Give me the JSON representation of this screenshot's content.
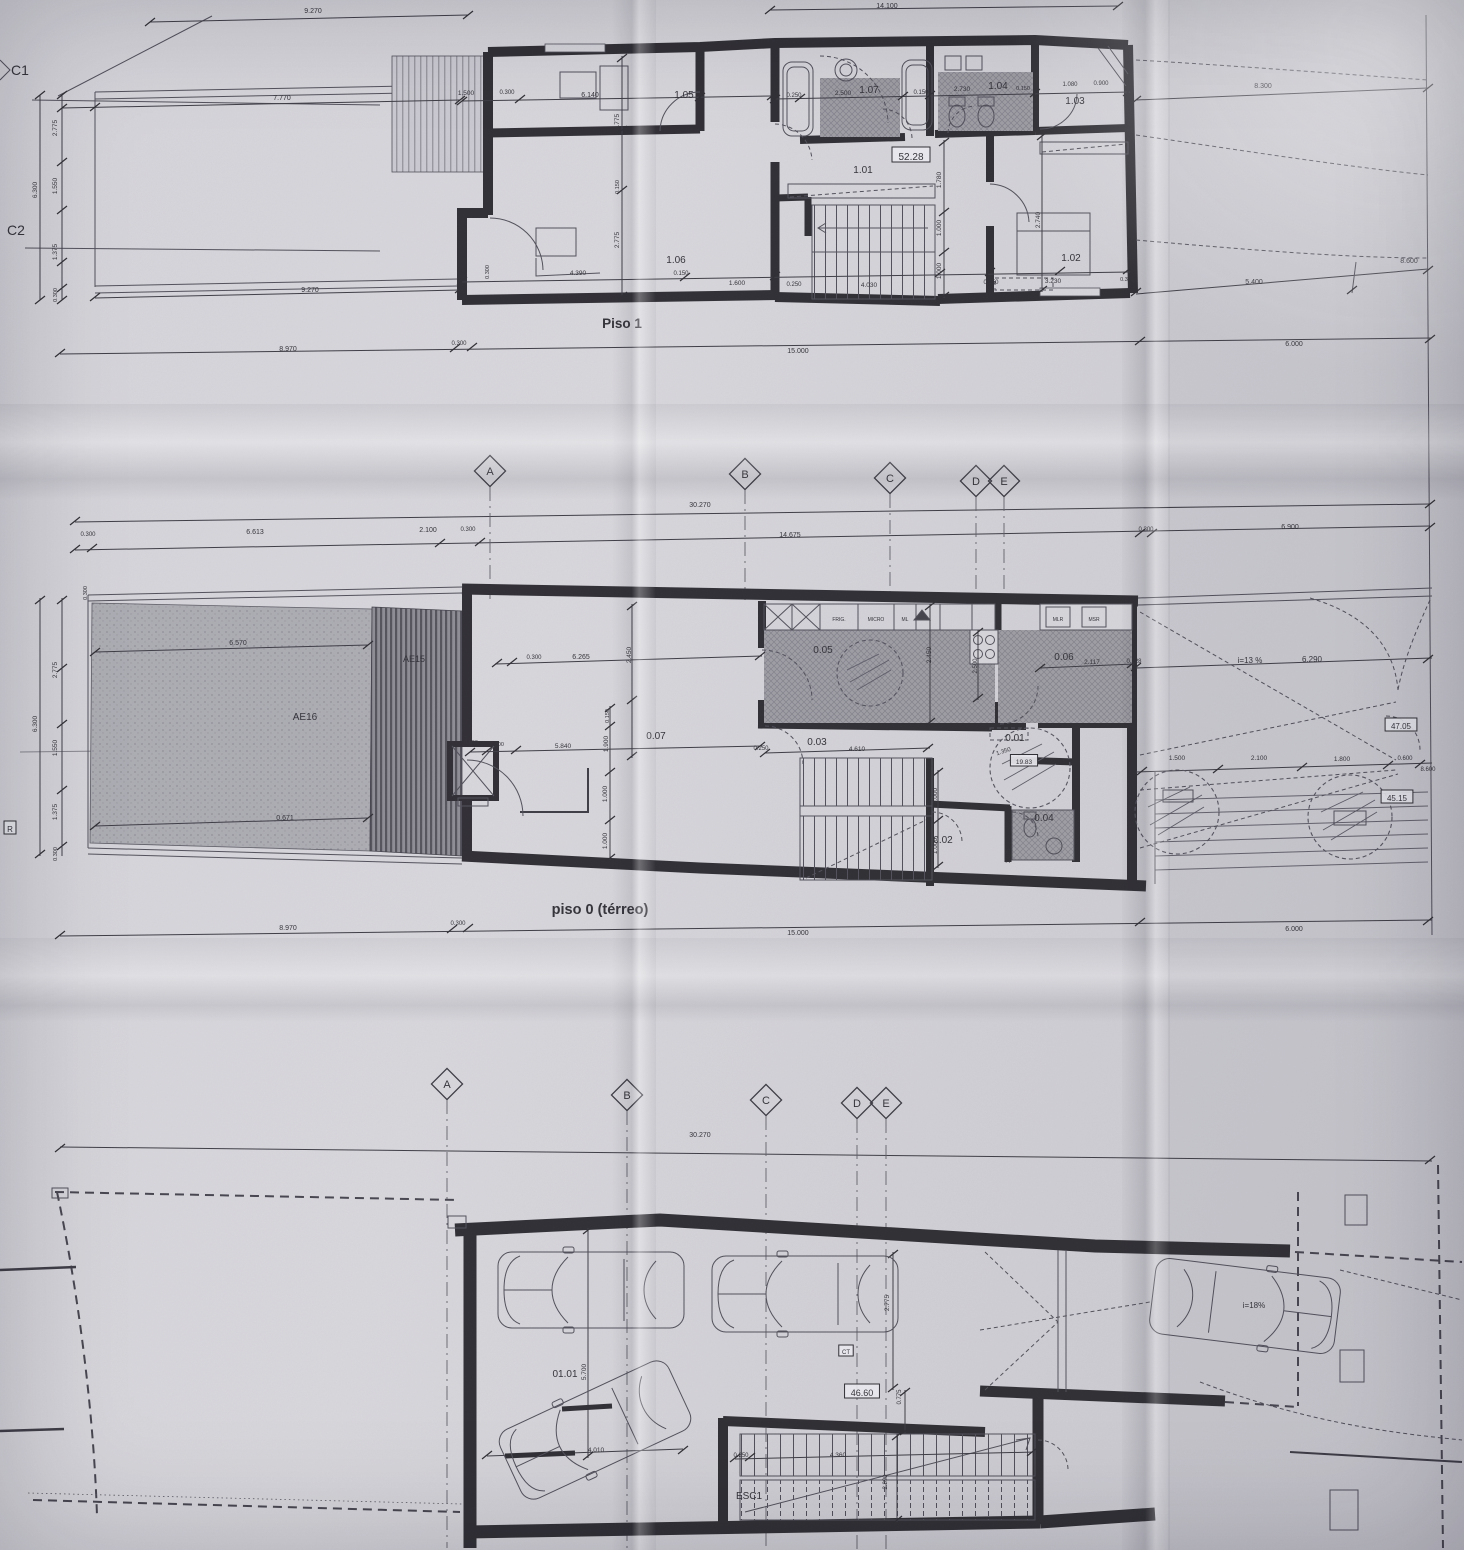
{
  "titles": {
    "piso1": "Piso 1",
    "piso0": "piso 0 (térreo)"
  },
  "labels": {
    "piso1": [
      {
        "t": "9.270",
        "x": 313,
        "y": 13,
        "s": 7
      },
      {
        "t": "14.100",
        "x": 887,
        "y": 8,
        "s": 7
      },
      {
        "t": "C1",
        "x": 20,
        "y": 75,
        "s": 14,
        "n": "grid-label-c1"
      },
      {
        "t": "C2",
        "x": 16,
        "y": 235,
        "s": 14,
        "n": "grid-label-c2"
      },
      {
        "t": "7.770",
        "x": 282,
        "y": 100,
        "s": 7
      },
      {
        "t": "2.775",
        "x": 57,
        "y": 128,
        "r": -90,
        "s": 6.5
      },
      {
        "t": "6.300",
        "x": 37,
        "y": 190,
        "r": -90,
        "s": 6.5
      },
      {
        "t": "1.550",
        "x": 57,
        "y": 186,
        "r": -90,
        "s": 6.5
      },
      {
        "t": "1.375",
        "x": 57,
        "y": 252,
        "r": -90,
        "s": 6.5
      },
      {
        "t": "0.300",
        "x": 57,
        "y": 295,
        "r": -90,
        "s": 5.5
      },
      {
        "t": "1.500",
        "x": 466,
        "y": 95,
        "s": 6.5
      },
      {
        "t": "0.300",
        "x": 507,
        "y": 94,
        "s": 6
      },
      {
        "t": "6.140",
        "x": 590,
        "y": 97,
        "s": 7
      },
      {
        "t": "1.05",
        "x": 684,
        "y": 98,
        "s": 10,
        "n": "room-label-1-05"
      },
      {
        "t": "2.775",
        "x": 619,
        "y": 122,
        "r": -90,
        "s": 6.5
      },
      {
        "t": "0.250",
        "x": 794,
        "y": 97,
        "s": 6
      },
      {
        "t": "2.500",
        "x": 843,
        "y": 95,
        "s": 6.5
      },
      {
        "t": "1.07",
        "x": 869,
        "y": 93,
        "s": 10,
        "n": "room-label-1-07"
      },
      {
        "t": "0.150",
        "x": 921,
        "y": 94,
        "s": 6
      },
      {
        "t": "2.730",
        "x": 962,
        "y": 91,
        "s": 6.5
      },
      {
        "t": "1.04",
        "x": 998,
        "y": 89,
        "s": 10,
        "n": "room-label-1-04"
      },
      {
        "t": "0.150",
        "x": 1023,
        "y": 90,
        "s": 5.5
      },
      {
        "t": "1.080",
        "x": 1070,
        "y": 86,
        "s": 6
      },
      {
        "t": "0.900",
        "x": 1101,
        "y": 85,
        "s": 6
      },
      {
        "t": "1.03",
        "x": 1075,
        "y": 104,
        "s": 10,
        "n": "room-label-1-03"
      },
      {
        "t": "8.300",
        "x": 1263,
        "y": 88,
        "s": 7
      },
      {
        "t": "52.28",
        "x": 911,
        "y": 160,
        "s": 10,
        "b": 1,
        "n": "area-value-piso1"
      },
      {
        "t": "1.01",
        "x": 863,
        "y": 173,
        "s": 10,
        "n": "room-label-1-01"
      },
      {
        "t": "1.780",
        "x": 941,
        "y": 180,
        "r": -90,
        "s": 6.5
      },
      {
        "t": "1.000",
        "x": 941,
        "y": 228,
        "r": -90,
        "s": 6.5
      },
      {
        "t": "1.000",
        "x": 941,
        "y": 271,
        "r": -90,
        "s": 6.5
      },
      {
        "t": "2.740",
        "x": 1040,
        "y": 220,
        "r": -90,
        "s": 6.5
      },
      {
        "t": "1.02",
        "x": 1071,
        "y": 261,
        "s": 10,
        "n": "room-label-1-02"
      },
      {
        "t": "1.06",
        "x": 676,
        "y": 263,
        "s": 10,
        "n": "room-label-1-06"
      },
      {
        "t": "2.775",
        "x": 619,
        "y": 240,
        "r": -90,
        "s": 6.5
      },
      {
        "t": "0.150",
        "x": 619,
        "y": 187,
        "r": -90,
        "s": 5.5
      },
      {
        "t": "4.390",
        "x": 578,
        "y": 275,
        "s": 6.5
      },
      {
        "t": "0.150",
        "x": 681,
        "y": 275,
        "s": 6
      },
      {
        "t": "0.300",
        "x": 489,
        "y": 272,
        "r": -90,
        "s": 5.5
      },
      {
        "t": "1.600",
        "x": 737,
        "y": 285,
        "s": 6.5
      },
      {
        "t": "0.250",
        "x": 794,
        "y": 286,
        "s": 6
      },
      {
        "t": "4.030",
        "x": 869,
        "y": 287,
        "s": 6.5
      },
      {
        "t": "0.150",
        "x": 991,
        "y": 284,
        "s": 6
      },
      {
        "t": "3.230",
        "x": 1053,
        "y": 283,
        "s": 6.5
      },
      {
        "t": "0.300",
        "x": 1127,
        "y": 281,
        "s": 5.5
      },
      {
        "t": "5.400",
        "x": 1254,
        "y": 284,
        "s": 7
      },
      {
        "t": "8.600",
        "x": 1409,
        "y": 263,
        "s": 7
      },
      {
        "t": "9.270",
        "x": 310,
        "y": 292,
        "s": 7
      },
      {
        "t": "8.970",
        "x": 288,
        "y": 351,
        "s": 7
      },
      {
        "t": "0.300",
        "x": 459,
        "y": 345,
        "s": 6
      },
      {
        "t": "15.000",
        "x": 798,
        "y": 353,
        "s": 7
      },
      {
        "t": "6.000",
        "x": 1294,
        "y": 346,
        "s": 7
      }
    ],
    "grid1": [
      {
        "k": "dia",
        "t": "A",
        "x": 490,
        "y": 471,
        "len": 112,
        "n": "grid-marker-a"
      },
      {
        "k": "dia",
        "t": "B",
        "x": 745,
        "y": 474,
        "len": 110,
        "n": "grid-marker-b"
      },
      {
        "k": "dia",
        "t": "C",
        "x": 890,
        "y": 478,
        "len": 106,
        "n": "grid-marker-c"
      },
      {
        "k": "dia",
        "t": "D",
        "x": 976,
        "y": 481,
        "len": 103,
        "n": "grid-marker-d"
      },
      {
        "k": "dia",
        "t": "E",
        "x": 1004,
        "y": 481,
        "len": 103,
        "n": "grid-marker-e"
      },
      {
        "t": "30.270",
        "x": 700,
        "y": 507,
        "s": 7
      },
      {
        "t": "0.300",
        "x": 88,
        "y": 536,
        "s": 6
      },
      {
        "t": "6.613",
        "x": 255,
        "y": 534,
        "s": 7
      },
      {
        "t": "2.100",
        "x": 428,
        "y": 532,
        "s": 7
      },
      {
        "t": "0.300",
        "x": 468,
        "y": 531,
        "s": 6
      },
      {
        "t": "14.675",
        "x": 790,
        "y": 537,
        "s": 7
      },
      {
        "t": "0.300",
        "x": 1146,
        "y": 531,
        "s": 6
      },
      {
        "t": "6.900",
        "x": 1290,
        "y": 529,
        "s": 7
      }
    ],
    "piso0": [
      {
        "t": "AE16",
        "x": 305,
        "y": 720,
        "s": 10,
        "n": "zone-label-ae16"
      },
      {
        "t": "AE15",
        "x": 414,
        "y": 662,
        "s": 9,
        "n": "zone-label-ae15"
      },
      {
        "t": "6.570",
        "x": 238,
        "y": 645,
        "s": 7
      },
      {
        "t": "0.300",
        "x": 87,
        "y": 593,
        "r": -90,
        "s": 5.5
      },
      {
        "t": "2.775",
        "x": 57,
        "y": 670,
        "r": -90,
        "s": 6.5
      },
      {
        "t": "6.300",
        "x": 37,
        "y": 724,
        "r": -90,
        "s": 6.5
      },
      {
        "t": "1.550",
        "x": 57,
        "y": 748,
        "r": -90,
        "s": 6.5
      },
      {
        "t": "1.375",
        "x": 57,
        "y": 812,
        "r": -90,
        "s": 6.5
      },
      {
        "t": "0.300",
        "x": 57,
        "y": 854,
        "r": -90,
        "s": 5.5
      },
      {
        "t": "R",
        "x": 10,
        "y": 832,
        "s": 8,
        "b": 1,
        "n": "grid-label-r"
      },
      {
        "t": "0.671",
        "x": 285,
        "y": 820,
        "s": 7
      },
      {
        "t": "0.300",
        "x": 534,
        "y": 659,
        "s": 6
      },
      {
        "t": "6.265",
        "x": 581,
        "y": 659,
        "s": 7
      },
      {
        "t": "2.450",
        "x": 631,
        "y": 655,
        "r": -90,
        "s": 6.5
      },
      {
        "t": "0.05",
        "x": 823,
        "y": 653,
        "s": 10,
        "n": "room-label-0-05"
      },
      {
        "t": "FRIG.",
        "x": 839,
        "y": 621,
        "s": 5
      },
      {
        "t": "MICRO",
        "x": 876,
        "y": 621,
        "s": 5
      },
      {
        "t": "ML",
        "x": 905,
        "y": 621,
        "s": 5
      },
      {
        "t": "2.450",
        "x": 931,
        "y": 655,
        "r": -90,
        "s": 6.5
      },
      {
        "t": "2.500",
        "x": 977,
        "y": 666,
        "r": -90,
        "s": 6
      },
      {
        "t": "MLR",
        "x": 1058,
        "y": 621,
        "s": 5
      },
      {
        "t": "MSR",
        "x": 1094,
        "y": 621,
        "s": 5
      },
      {
        "t": "0.06",
        "x": 1064,
        "y": 660,
        "s": 10,
        "n": "room-label-0-06"
      },
      {
        "t": "2.117",
        "x": 1092,
        "y": 664,
        "s": 6.5
      },
      {
        "t": "0.228",
        "x": 1134,
        "y": 663,
        "s": 6
      },
      {
        "t": "i=13 %",
        "x": 1250,
        "y": 663,
        "s": 8
      },
      {
        "t": "6.290",
        "x": 1312,
        "y": 662,
        "s": 8
      },
      {
        "t": "47.05",
        "x": 1401,
        "y": 729,
        "s": 8,
        "b": 1,
        "n": "area-value-ramp-upper"
      },
      {
        "t": "45.15",
        "x": 1397,
        "y": 801,
        "s": 8,
        "b": 1,
        "n": "area-value-ramp-lower"
      },
      {
        "t": "0.07",
        "x": 656,
        "y": 739,
        "s": 10,
        "n": "room-label-0-07"
      },
      {
        "t": "0.590",
        "x": 471,
        "y": 744,
        "s": 5.5
      },
      {
        "t": "0.300",
        "x": 497,
        "y": 746,
        "s": 5.5
      },
      {
        "t": "5.840",
        "x": 563,
        "y": 748,
        "s": 6.5
      },
      {
        "t": "0.150",
        "x": 609,
        "y": 716,
        "r": -90,
        "s": 5.5
      },
      {
        "t": "1.900",
        "x": 608,
        "y": 744,
        "r": -90,
        "s": 6.5
      },
      {
        "t": "1.000",
        "x": 607,
        "y": 794,
        "r": -90,
        "s": 6.5
      },
      {
        "t": "1.000",
        "x": 607,
        "y": 841,
        "r": -90,
        "s": 6.5
      },
      {
        "t": "0.03",
        "x": 817,
        "y": 745,
        "s": 10,
        "n": "room-label-0-03"
      },
      {
        "t": "0.250",
        "x": 761,
        "y": 750,
        "s": 6
      },
      {
        "t": "4.610",
        "x": 857,
        "y": 751,
        "s": 6.5
      },
      {
        "t": "1.000",
        "x": 937,
        "y": 796,
        "r": -90,
        "s": 6.5
      },
      {
        "t": "1.000",
        "x": 937,
        "y": 846,
        "r": -90,
        "s": 6.5
      },
      {
        "t": "1.350",
        "x": 1004,
        "y": 753,
        "r": -18,
        "s": 6
      },
      {
        "t": "0.01",
        "x": 1015,
        "y": 741,
        "s": 10,
        "n": "room-label-0-01"
      },
      {
        "t": "19.83",
        "x": 1024,
        "y": 764,
        "s": 6.5,
        "b": 1,
        "n": "area-value-0-01"
      },
      {
        "t": "0.02",
        "x": 943,
        "y": 843,
        "s": 10,
        "n": "room-label-0-02"
      },
      {
        "t": "0.04",
        "x": 1044,
        "y": 821,
        "s": 10,
        "n": "room-label-0-04"
      },
      {
        "t": "1.075",
        "x": 1010,
        "y": 856,
        "r": -90,
        "s": 6
      },
      {
        "t": "1.500",
        "x": 1177,
        "y": 760,
        "s": 6.5
      },
      {
        "t": "2.100",
        "x": 1259,
        "y": 760,
        "s": 6.5
      },
      {
        "t": "1.800",
        "x": 1342,
        "y": 761,
        "s": 6.5
      },
      {
        "t": "0.600",
        "x": 1405,
        "y": 760,
        "s": 6
      },
      {
        "t": "8.600",
        "x": 1428,
        "y": 771,
        "s": 6
      },
      {
        "t": "8.970",
        "x": 288,
        "y": 930,
        "s": 7
      },
      {
        "t": "0.300",
        "x": 458,
        "y": 925,
        "s": 6
      },
      {
        "t": "15.000",
        "x": 798,
        "y": 935,
        "s": 7
      },
      {
        "t": "6.000",
        "x": 1294,
        "y": 931,
        "s": 7
      }
    ],
    "grid2": [
      {
        "k": "dia",
        "t": "A",
        "x": 447,
        "y": 1084,
        "len": 448,
        "n": "grid-marker-a2"
      },
      {
        "k": "dia",
        "t": "B",
        "x": 627,
        "y": 1095,
        "len": 440,
        "n": "grid-marker-b2"
      },
      {
        "k": "dia",
        "t": "C",
        "x": 766,
        "y": 1100,
        "len": 438,
        "n": "grid-marker-c2"
      },
      {
        "k": "dia",
        "t": "D",
        "x": 857,
        "y": 1103,
        "len": 436,
        "n": "grid-marker-d2"
      },
      {
        "k": "dia",
        "t": "E",
        "x": 886,
        "y": 1103,
        "len": 436,
        "n": "grid-marker-e2"
      },
      {
        "t": "30.270",
        "x": 700,
        "y": 1137,
        "s": 7
      }
    ],
    "garagem": [
      {
        "t": "01.01",
        "x": 565,
        "y": 1377,
        "s": 10,
        "n": "room-label-01-01"
      },
      {
        "t": "5.700",
        "x": 586,
        "y": 1372,
        "r": -90,
        "s": 6.5
      },
      {
        "t": "4.010",
        "x": 596,
        "y": 1452,
        "s": 6.5
      },
      {
        "t": "2.775",
        "x": 889,
        "y": 1303,
        "r": -90,
        "s": 6.5
      },
      {
        "t": "CT",
        "x": 846,
        "y": 1354,
        "s": 6,
        "b": 1,
        "n": "ct-box"
      },
      {
        "t": "46.60",
        "x": 862,
        "y": 1396,
        "s": 9,
        "b": 1,
        "n": "area-value-garage"
      },
      {
        "t": "0.775",
        "x": 901,
        "y": 1397,
        "r": -90,
        "s": 6
      },
      {
        "t": "0.250",
        "x": 741,
        "y": 1457,
        "s": 6
      },
      {
        "t": "4.360",
        "x": 838,
        "y": 1457,
        "s": 6.5
      },
      {
        "t": "2.890",
        "x": 887,
        "y": 1482,
        "r": -90,
        "s": 6
      },
      {
        "t": "ESC1",
        "x": 749,
        "y": 1499,
        "s": 10,
        "n": "stair-label-esc1"
      },
      {
        "t": "i=18%",
        "x": 1254,
        "y": 1308,
        "s": 8
      }
    ]
  }
}
